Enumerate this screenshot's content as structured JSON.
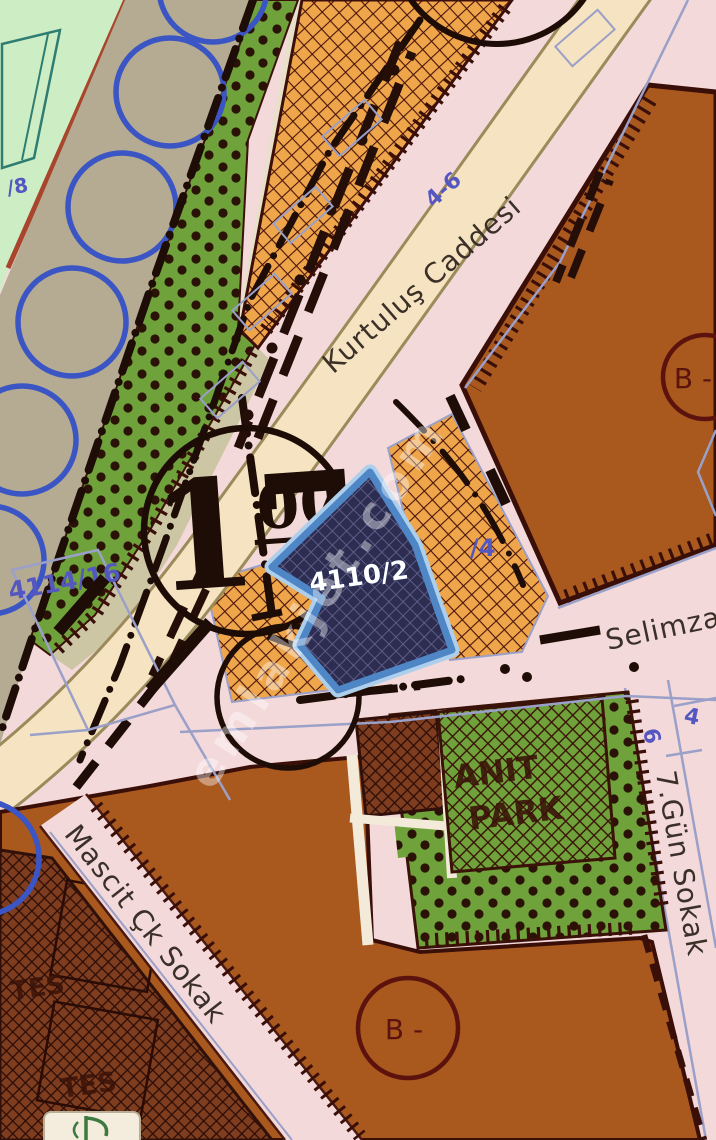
{
  "map": {
    "streets": {
      "kurtulus": "Kurtuluş Caddesi",
      "selimzade": "Selimzade",
      "mascit": "Mascit Çk Sokak",
      "yedigun": "7.Gün Sokak"
    },
    "parcels": {
      "highlighted": "4110/2",
      "left_block": "4114/16",
      "top_left": "/8",
      "right_of_parcel": "/4",
      "range_top": "4-6",
      "park_side_six": "6",
      "park_side_four": "4"
    },
    "zones": {
      "b_upper": "B -",
      "b_lower": "B -",
      "plan_note_main": "17",
      "plan_note_sup": "00",
      "anit_line1": "ANIT",
      "anit_line2": "PARK",
      "tes_upper": "TES",
      "tes_lower": "TES"
    },
    "watermark": "emlakjet.com",
    "colors": {
      "highlight_stroke": "#4e86c6",
      "highlight_fill": "#2d2d52",
      "park_green": "#6fa23a",
      "block_brown": "#a9581e",
      "orange_zone": "#efa64b",
      "road_pink": "#f3d9da",
      "road_cream": "#f6e3c1",
      "circle_blue": "#3b55c4"
    }
  }
}
